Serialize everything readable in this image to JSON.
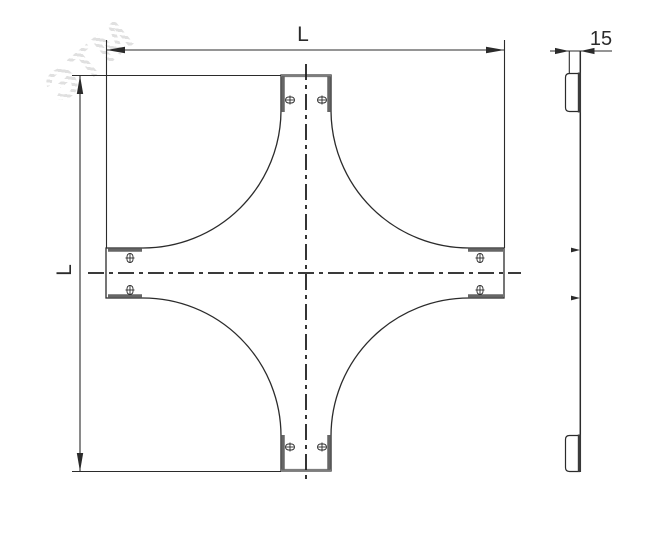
{
  "front_view": {
    "width_label": "L",
    "height_label": "L"
  },
  "side_view": {
    "thickness_label": "15"
  },
  "watermark": {
    "text": "ЭТМ"
  },
  "colors": {
    "line": "#2b2b2b",
    "flange": "#666666",
    "tip_edge": "#7d7d7d",
    "centerline": "#1f1f1f",
    "watermark": "#e0e0e0",
    "background": "#ffffff"
  }
}
